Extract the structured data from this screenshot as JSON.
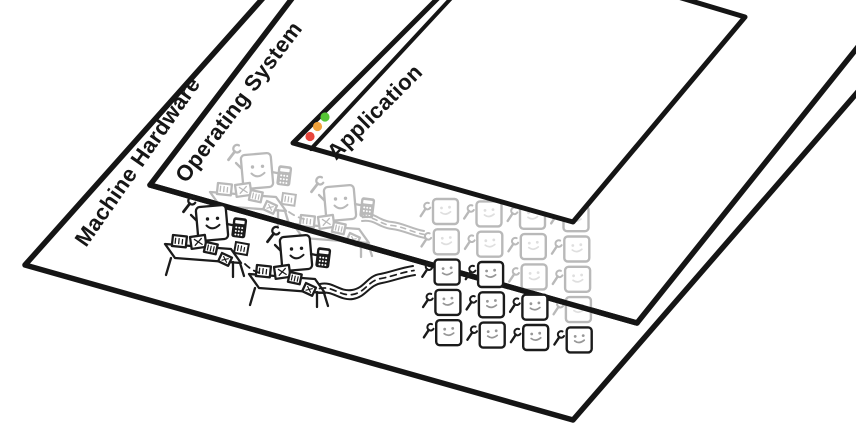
{
  "layers": [
    {
      "id": "machine-hardware",
      "label": "Machine Hardware"
    },
    {
      "id": "operating-system",
      "label": "Operating System"
    },
    {
      "id": "application",
      "label": "Application"
    }
  ],
  "application_window": {
    "controls": [
      {
        "name": "close",
        "color": "#e8453c"
      },
      {
        "name": "minimize",
        "color": "#f2a33c"
      },
      {
        "name": "maximize",
        "color": "#55c635"
      }
    ]
  },
  "workers": {
    "active_color": "#1b1b1b",
    "faded_color": "#b9b9b9",
    "grid_rows": 5,
    "grid_cols": 4,
    "grid_map": [
      [
        "faded",
        "faded",
        "faded",
        "faded"
      ],
      [
        "faded",
        "faded",
        "faded",
        "faded"
      ],
      [
        "active",
        "active",
        "faded",
        "faded"
      ],
      [
        "active",
        "active",
        "active",
        "faded"
      ],
      [
        "active",
        "active",
        "active",
        "active"
      ]
    ]
  }
}
